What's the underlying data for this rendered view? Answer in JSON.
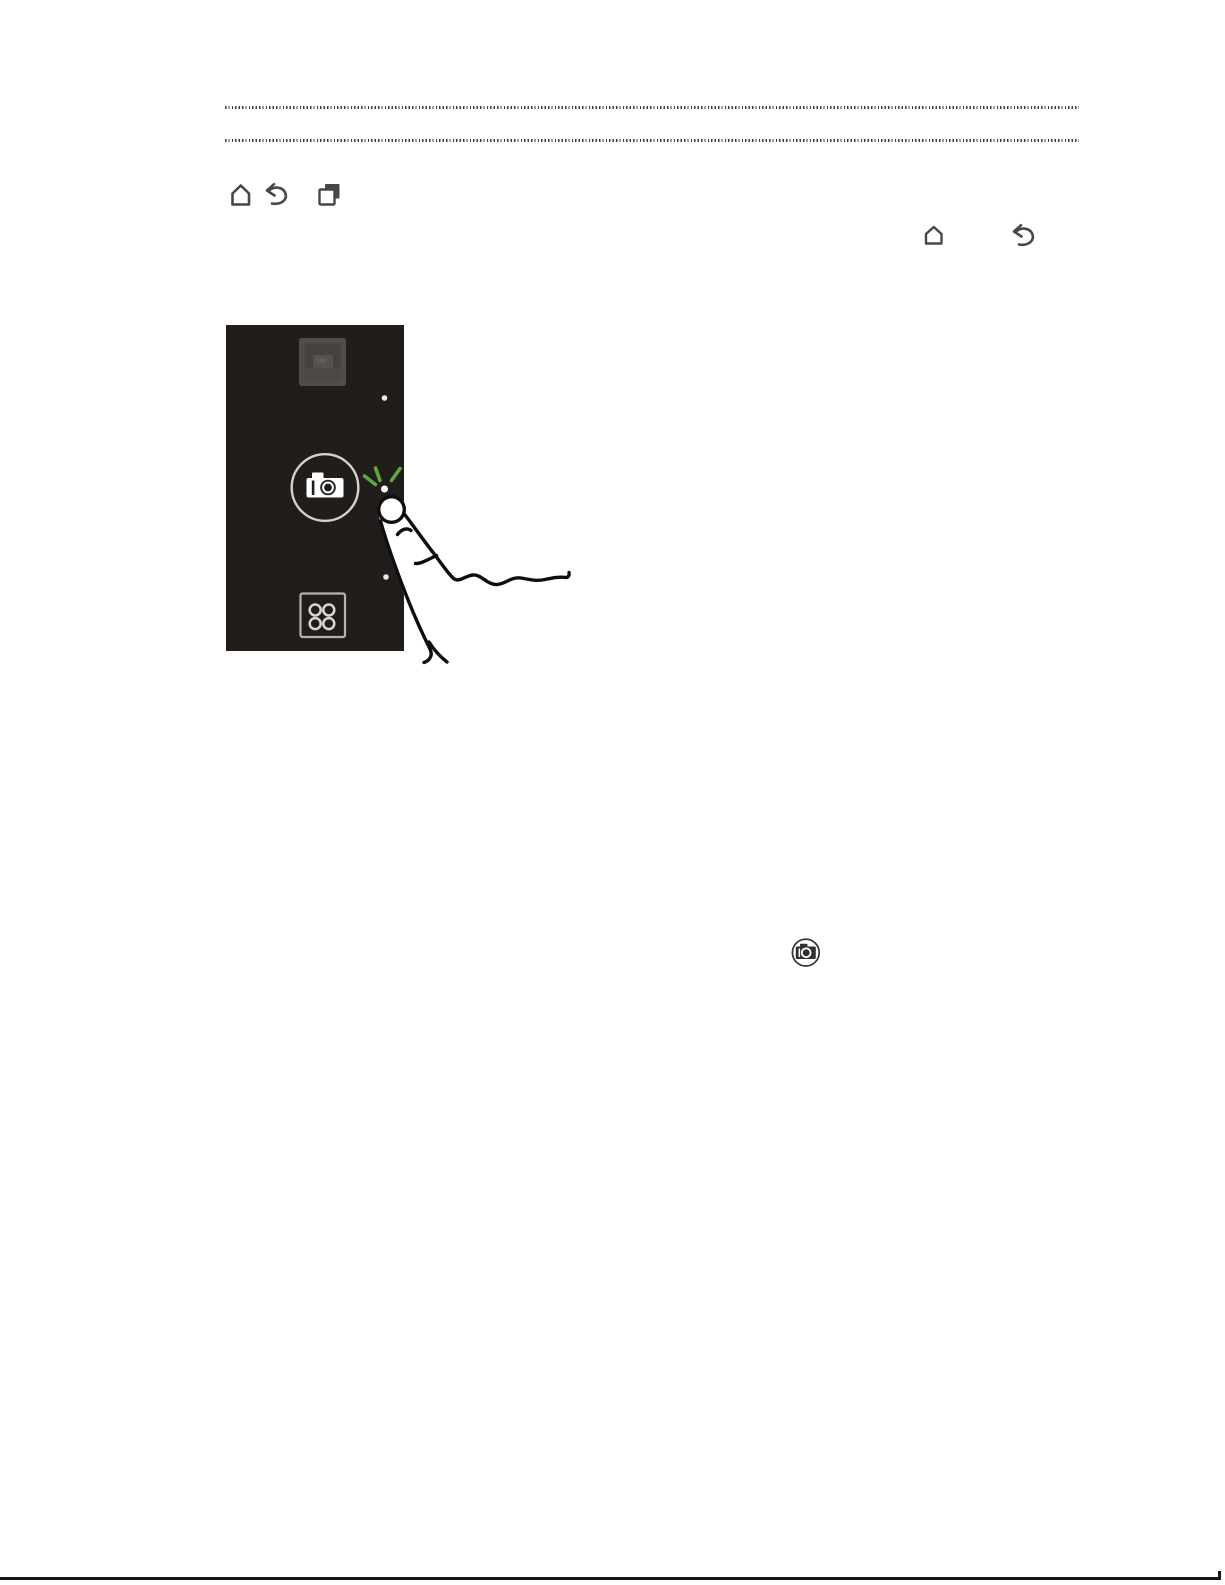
{
  "document": {
    "type": "phone-user-guide-page",
    "visible_text": "",
    "colors": {
      "page_background": "#ffffff",
      "divider_dots": "#3d3d3d",
      "icon_grey": "#474747",
      "phone_screen_background": "#201d1b",
      "phone_glyph_white": "#d8d6d4",
      "tap_burst_green": "#5ca83f",
      "bottom_rule": "#151515"
    },
    "figures": {
      "dotted_dividers": 2,
      "nav_buttons_row": {
        "icons": [
          "home-icon",
          "back-icon",
          "recent-apps-icon"
        ]
      },
      "inline_icon_row": {
        "icons": [
          "home-icon",
          "back-icon"
        ]
      },
      "phone_screen": {
        "elements": [
          "gallery-widget-icon",
          "indicator-dot-top",
          "camera-launch-button",
          "camera-icon",
          "tap-indicator-dot",
          "green-tap-burst",
          "indicator-dot-bottom",
          "app-drawer-button",
          "pointing-finger-illustration"
        ]
      },
      "inline_camera_icon": "camera-icon",
      "page_bottom_rule": true
    }
  }
}
